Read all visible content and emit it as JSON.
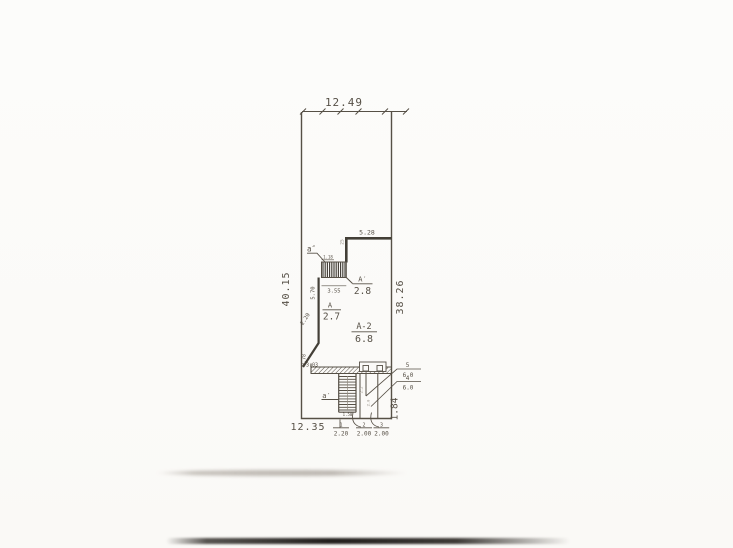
{
  "colors": {
    "ink": "#4e473d",
    "ink_dark": "#3a352d",
    "paper": "#fcfbf9",
    "scan_shadow": "#211f1c"
  },
  "dimensions": {
    "top_width": "12.49",
    "left_height": "40.15",
    "right_height": "38.26",
    "inner_wall_top": "5.28",
    "wall_thickness": "25",
    "upper_stair_width": "1.18",
    "upper_stair_run": "3.55",
    "left_inner_wall": "5.70",
    "diagonal_wall": "2.20",
    "lower_left_wall": "0.78",
    "lower_offset": "3.03",
    "bottom_width": "12.35",
    "right_lower_height": "1.84",
    "lower_stair_width": "1.50"
  },
  "stairs": {
    "upper_label": "a″",
    "lower_label": "a′"
  },
  "rooms": [
    {
      "name": "A",
      "value": "2.7"
    },
    {
      "name": "A′",
      "value": "2.8"
    },
    {
      "name": "A-2",
      "value": "6.8"
    }
  ],
  "bottom_marks": [
    {
      "num": "1",
      "value": "2.20"
    },
    {
      "num": "2",
      "value": "2.00"
    },
    {
      "num": "3",
      "value": "2.00"
    }
  ],
  "side_marks": [
    {
      "num": "5",
      "value": "6.0"
    },
    {
      "num": "4",
      "value": "6.0"
    }
  ],
  "interior_marks": [
    "2.2",
    "2.0"
  ]
}
